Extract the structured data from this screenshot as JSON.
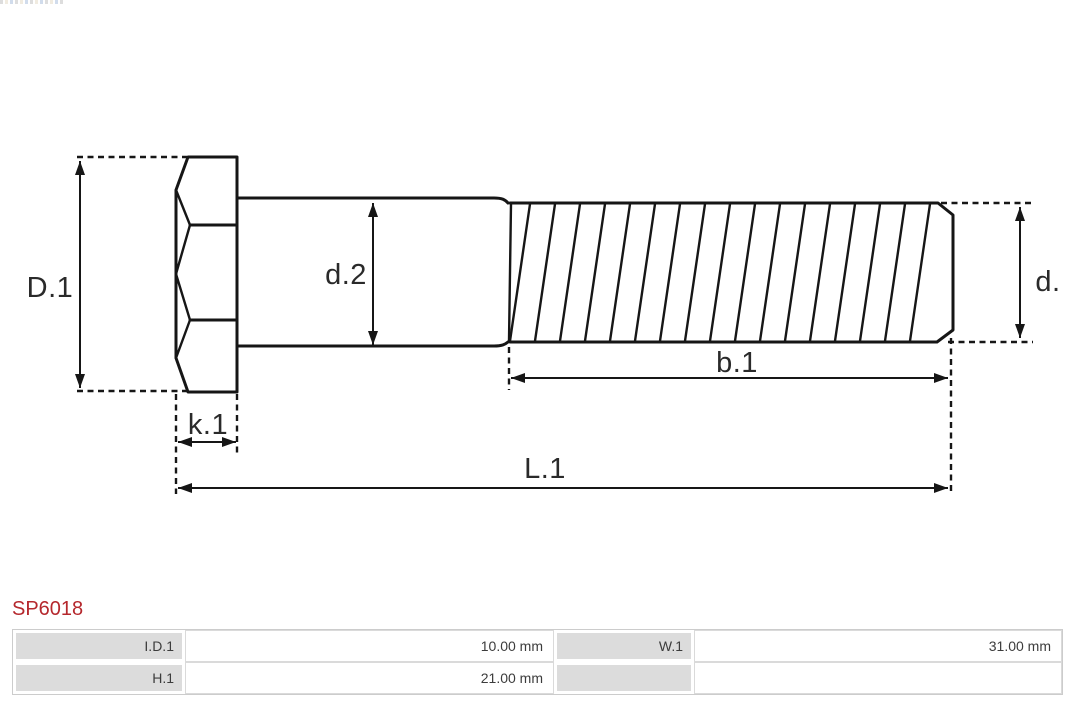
{
  "diagram": {
    "kind": "technical-drawing",
    "subject": "hex head bolt, side view with threaded shank",
    "labels": {
      "D1": "D.1",
      "d2": "d.2",
      "d": "d.",
      "b1": "b.1",
      "k1": "k.1",
      "L1": "L.1"
    }
  },
  "part_number": "SP6018",
  "table": {
    "rows": [
      {
        "cells": [
          {
            "label": "I.D.1",
            "value": "10.00 mm"
          },
          {
            "label": "W.1",
            "value": "31.00 mm"
          }
        ]
      },
      {
        "cells": [
          {
            "label": "H.1",
            "value": "21.00 mm"
          },
          {
            "label": "",
            "value": ""
          }
        ]
      }
    ]
  },
  "colors": {
    "accent_red": "#b5282d",
    "line": "#161616",
    "table_label_bg": "#dcdcdc",
    "table_border": "#cccccc"
  }
}
